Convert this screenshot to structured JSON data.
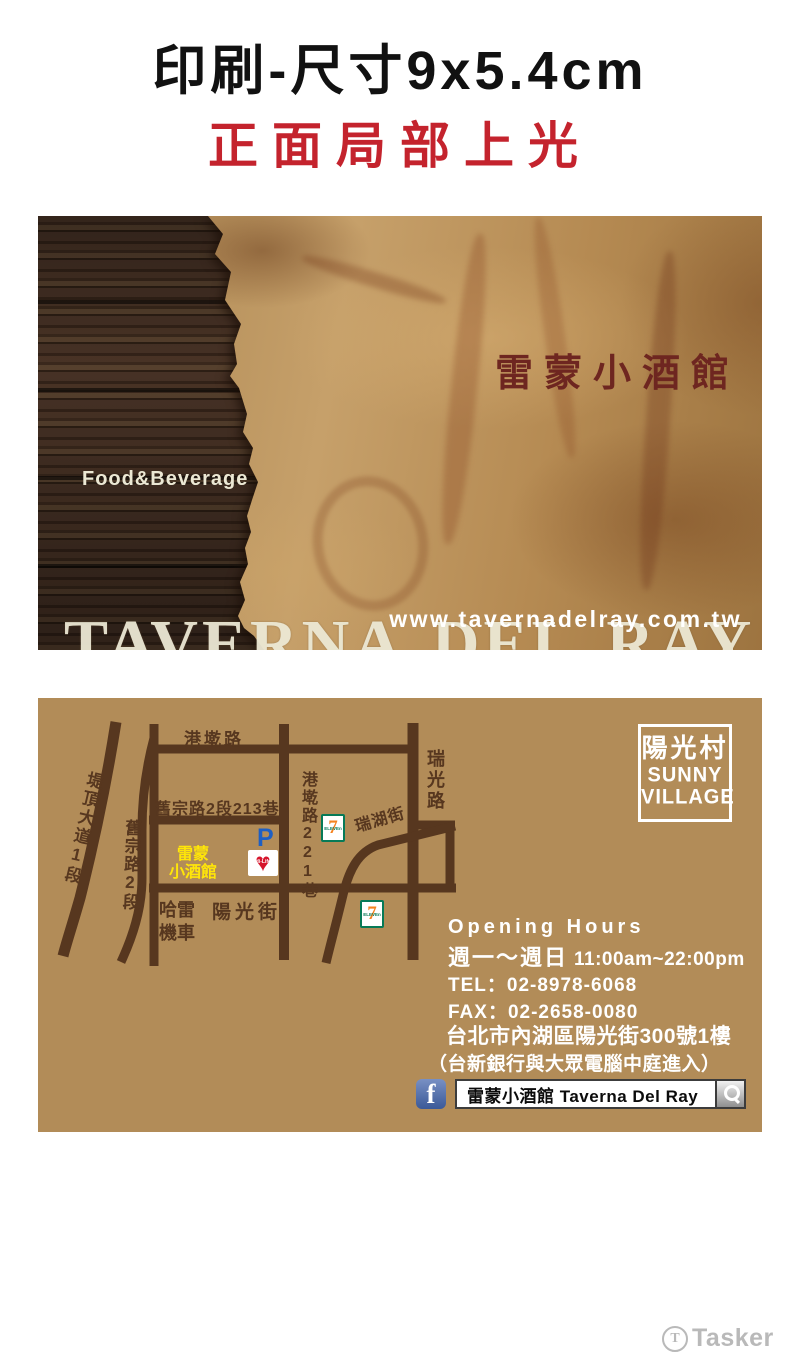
{
  "header": {
    "title": "印刷-尺寸9x5.4cm",
    "subtitle": "正面局部上光"
  },
  "card_front": {
    "shop_name_zh": "雷蒙小酒館",
    "shop_name_en": "TAVERNA DEL RAY",
    "tagline": "Food&Beverage",
    "website": "www.tavernadelray.com.tw"
  },
  "card_back": {
    "map": {
      "street_labels": {
        "gangqian_rd": "港墘路",
        "jiuzong_lane213": "舊宗路2段213巷",
        "gangqian_lane221": "港墘路221巷",
        "ruiguang_rd": "瑞光路",
        "ruihu_st": "瑞湖街",
        "tiding_blvd": "堤頂大道1段",
        "jiuzong_rd": "舊宗路2段",
        "yangguang_st": "陽光街"
      },
      "landmarks": {
        "shop_line1": "雷蒙",
        "shop_line2": "小酒館",
        "harley_line1": "哈雷",
        "harley_line2": "機車",
        "parking": "P",
        "hilife": "Hi-Life",
        "hilife_heart": "♥",
        "seven": "7",
        "seven_sub": "ELEVEn"
      },
      "badge": {
        "zh": "陽光村",
        "en_line1": "SUNNY",
        "en_line2": "VILLAGE"
      }
    },
    "info": {
      "opening_label": "Opening Hours",
      "days": "週一～週日",
      "hours": "11:00am~22:00pm",
      "tel": "TEL：02-8978-6068",
      "fax": "FAX：02-2658-0080",
      "address": "台北市內湖區陽光街300號1樓",
      "address_note": "（台新銀行與大眾電腦中庭進入）",
      "facebook": {
        "icon_letter": "f",
        "search_text": "雷蒙小酒館 Taverna Del Ray"
      }
    }
  },
  "watermark": {
    "icon_letter": "T",
    "brand": "Tasker"
  },
  "colors": {
    "red_accent": "#c4232d",
    "card_tan": "#b28c58",
    "road_brown": "#57371f",
    "shop_yellow": "#ffe608",
    "maroon": "#6e2620",
    "cream": "#ece8d4",
    "parking_blue": "#1d5fc4",
    "facebook_blue": "#3b5998",
    "hilife_red": "#d6152c",
    "seven_orange": "#f5821f",
    "seven_green": "#067a57",
    "watermark_gray": "#b9b9b9"
  }
}
